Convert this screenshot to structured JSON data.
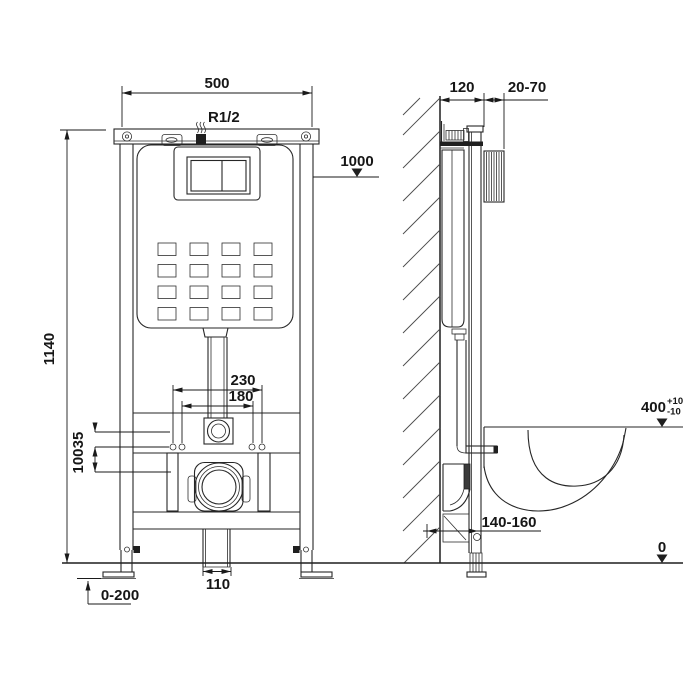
{
  "front_view": {
    "frame_width": "500",
    "water_inlet": "R1/2",
    "cistern_level": "1000",
    "frame_height": "1140",
    "bolt_spacing_outer": "230",
    "bolt_spacing_inner": "180",
    "inlet_offset": "35",
    "outlet_offset": "100",
    "outlet_duct_width": "110",
    "feet_adjustment": "0-200"
  },
  "side_view": {
    "frame_depth": "120",
    "finish_thickness": "20-70",
    "bowl_height": "400",
    "bowl_height_tol_plus": "+10",
    "bowl_height_tol_minus": "-10",
    "outlet_distance": "140-160",
    "floor_level": "0"
  }
}
